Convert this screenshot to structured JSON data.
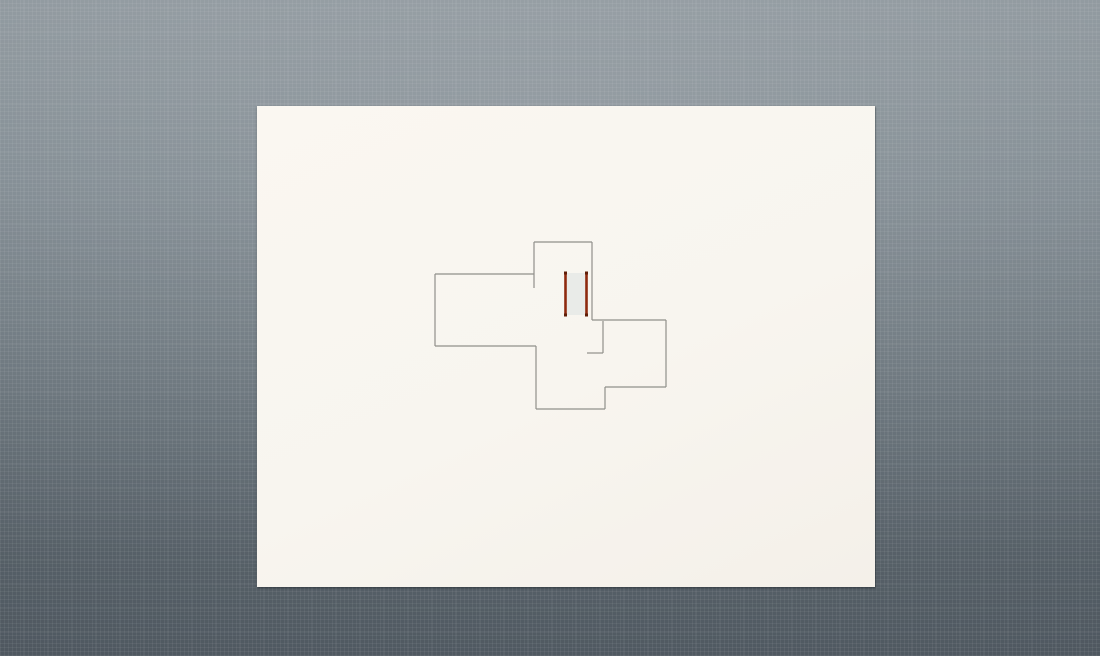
{
  "canvas": {
    "background_top_color": "#8f989e",
    "background_bottom_color": "#57616a",
    "texture_line_color": "rgba(255,255,255,0.055)"
  },
  "sheet": {
    "x": 257,
    "y": 106,
    "width": 618,
    "height": 481,
    "color": "#f8f5ef"
  },
  "plan": {
    "wall_color": "#90908a",
    "wall_width": 1.2,
    "walls": [
      [
        534,
        242,
        592,
        242
      ],
      [
        534,
        242,
        534,
        288
      ],
      [
        435,
        274,
        534,
        274
      ],
      [
        435,
        274,
        435,
        346
      ],
      [
        435,
        346,
        536,
        346
      ],
      [
        536,
        346,
        536,
        409
      ],
      [
        536,
        409,
        605,
        409
      ],
      [
        605,
        387,
        605,
        409
      ],
      [
        605,
        387,
        666,
        387
      ],
      [
        666,
        320,
        666,
        387
      ],
      [
        592,
        320,
        666,
        320
      ],
      [
        592,
        242,
        592,
        320
      ],
      [
        603,
        321,
        603,
        353
      ],
      [
        587,
        353,
        603,
        353
      ]
    ],
    "selected_wall": {
      "stroke_color": "#8e2a0f",
      "end_cap_color": "#5f1e08",
      "fill_color": "#e9ebe8",
      "fill_rect": [
        567,
        273,
        19,
        42
      ],
      "lines": [
        [
          565.5,
          273,
          565.5,
          315
        ],
        [
          586.5,
          273,
          586.5,
          315
        ]
      ],
      "stroke_width": 2.6,
      "end_cap_size": 3
    }
  }
}
